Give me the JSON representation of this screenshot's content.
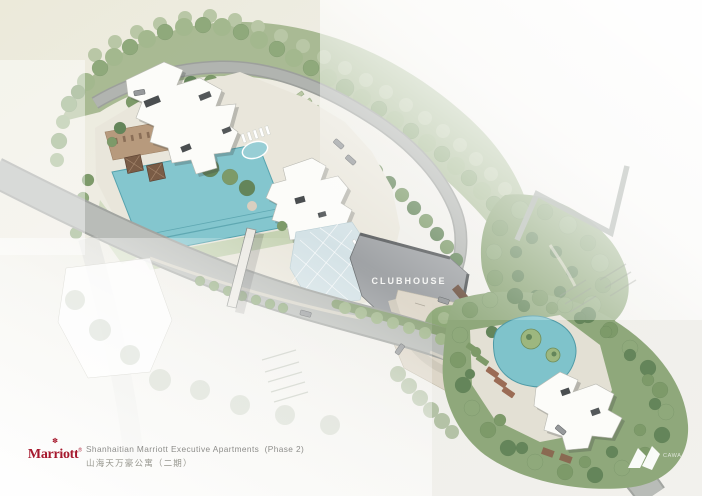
{
  "plan": {
    "clubhouse_label": "CLUBHOUSE"
  },
  "footer": {
    "brand": "Marriott",
    "brand_mark": "®",
    "emblem_glyph": "✽",
    "title_en": "Shanhaitian Marriott Executive Apartments  (Phase 2)",
    "title_zh": "山海天万豪公寓（二期）"
  },
  "watermark": {
    "logo_text": "CAWA"
  },
  "colors": {
    "marriott_red": "#a6192e",
    "pool_teal": "#7fc3cb",
    "plaza_blue": "#d4e2e6",
    "clubhouse_gray": "#9da0a3",
    "road_gray": "#b6b9b5",
    "tree_green": "#86a272",
    "deck_brown": "#b79a7d",
    "paper": "#f0efeb"
  }
}
